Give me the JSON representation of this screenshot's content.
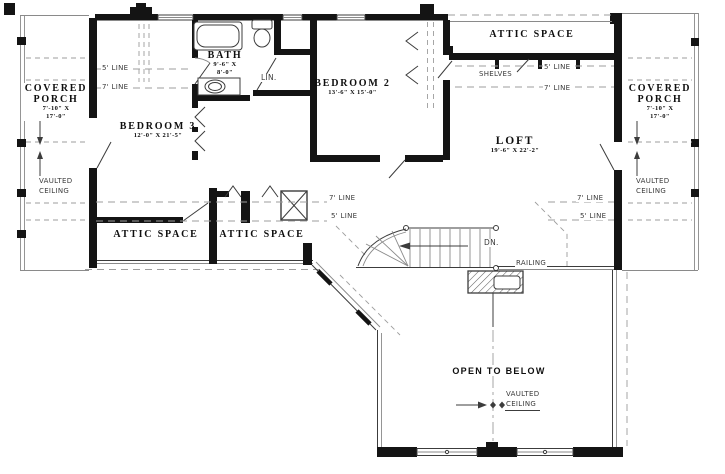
{
  "rooms": {
    "covered_porch": {
      "line1": "COVERED",
      "line2": "PORCH",
      "dim1": "7'-10\" X",
      "dim2": "17'-0\""
    },
    "bedroom3": {
      "name": "BEDROOM 3",
      "dims": "12'-0\" X 21'-5\""
    },
    "bath": {
      "name": "BATH",
      "dim1": "9'-6\" X",
      "dim2": "8'-0\""
    },
    "bedroom2": {
      "name": "BEDROOM 2",
      "dims": "13'-6\" X 15'-0\""
    },
    "attic_space": "ATTIC SPACE",
    "loft": {
      "name": "LOFT",
      "dims": "19'-6\" X 22'-2\""
    }
  },
  "annotations": {
    "line_5": "5' LINE",
    "line_7": "7' LINE",
    "shelves": "SHELVES",
    "linen": "LIN.",
    "down": "DN.",
    "railing": "RAILING",
    "open_to_below": "OPEN TO BELOW",
    "vaulted": "VAULTED",
    "ceiling": "CEILING"
  },
  "palette": {
    "ink": "#141414",
    "line": "#3c3c3c",
    "dashed": "#9d9d9d",
    "paper": "#ffffff"
  }
}
